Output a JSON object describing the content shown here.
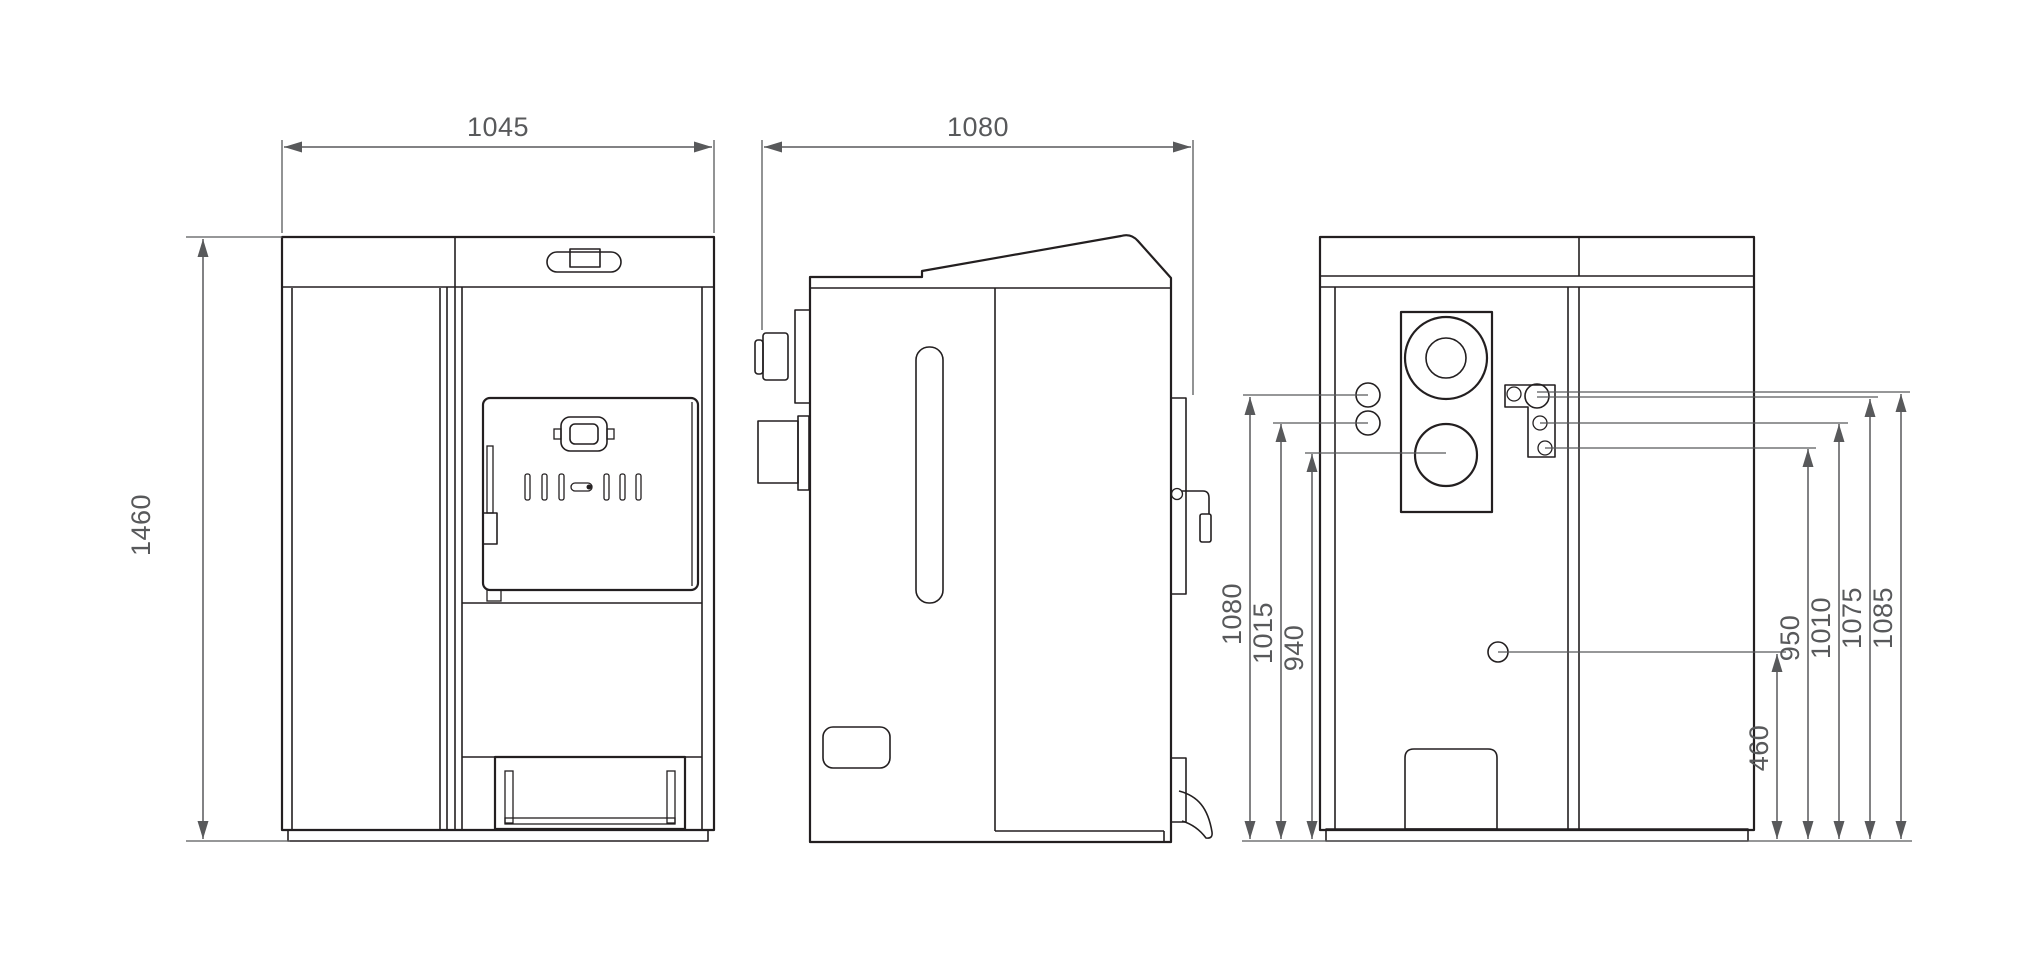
{
  "drawing": {
    "description": "Three-view dimensional technical drawing of a solid fuel boiler: front view, side view, rear view",
    "views": {
      "front": "front-view",
      "side": "side-view",
      "rear": "rear-view"
    }
  },
  "dims": {
    "front_width": "1045",
    "front_height": "1460",
    "side_depth": "1080",
    "rear": {
      "left": {
        "h1080": "1080",
        "h1015": "1015",
        "h940": "940"
      },
      "right": {
        "h460": "460",
        "h950": "950",
        "h1010": "1010",
        "h1075": "1075",
        "h1085": "1085"
      }
    }
  },
  "colors": {
    "line": "#231f20",
    "dimension": "#58595b",
    "background": "#ffffff"
  }
}
